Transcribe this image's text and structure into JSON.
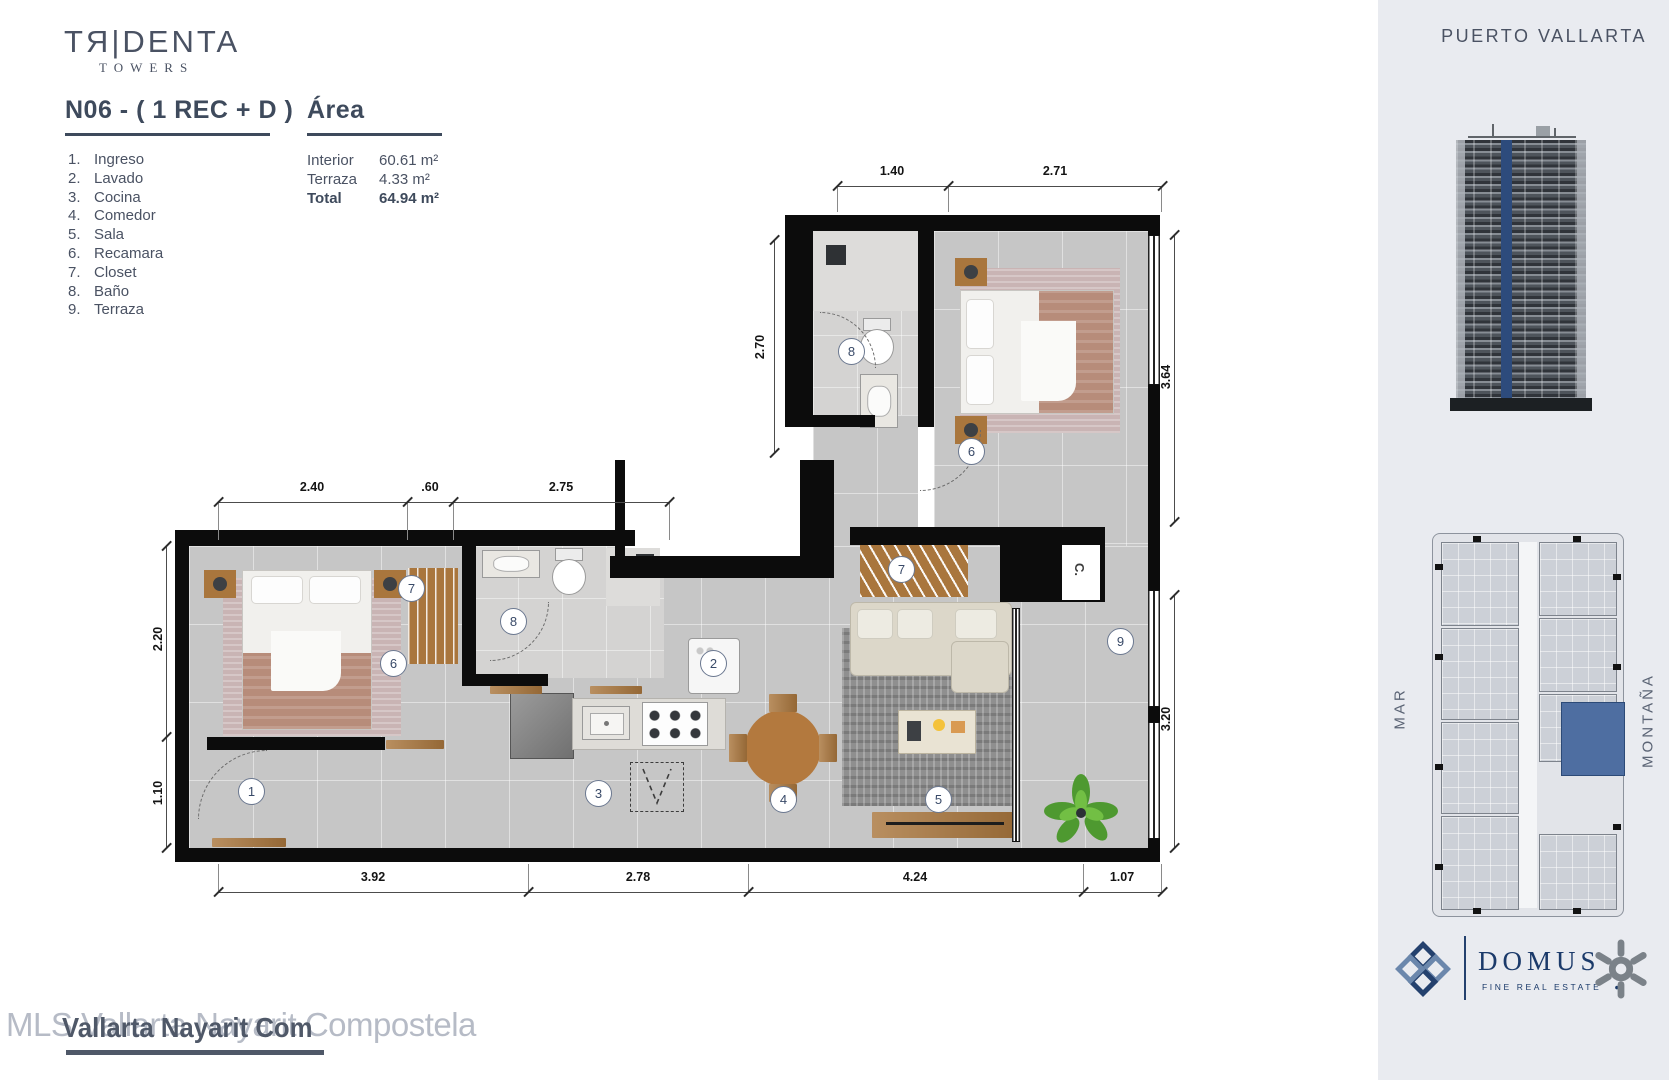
{
  "branding": {
    "logo": "TЯ|DENTA",
    "logo_sub": "TOWERS"
  },
  "header": {
    "unit_title": "N06 - ( 1 REC + D )",
    "area_title": "Área"
  },
  "legend": [
    {
      "num": "1.",
      "label": "Ingreso"
    },
    {
      "num": "2.",
      "label": "Lavado"
    },
    {
      "num": "3.",
      "label": "Cocina"
    },
    {
      "num": "4.",
      "label": "Comedor"
    },
    {
      "num": "5.",
      "label": "Sala"
    },
    {
      "num": "6.",
      "label": "Recamara"
    },
    {
      "num": "7.",
      "label": "Closet"
    },
    {
      "num": "8.",
      "label": "Baño"
    },
    {
      "num": "9.",
      "label": "Terraza"
    }
  ],
  "areas": [
    {
      "label": "Interior",
      "value": "60.61 m²"
    },
    {
      "label": "Terraza",
      "value": "4.33 m²"
    },
    {
      "label": "Total",
      "value": "64.94 m²"
    }
  ],
  "plan": {
    "dims": {
      "top1": "1.40",
      "top2": "2.71",
      "bath_h": "2.70",
      "wing1": "2.40",
      "wing2": ".60",
      "wing3": "2.75",
      "left1": "2.20",
      "left2": "1.10",
      "right1": "3.64",
      "right2": "3.20",
      "bottom1": "3.92",
      "bottom2": "2.78",
      "bottom3": "4.24",
      "bottom4": "1.07"
    },
    "markers": {
      "entry": "1",
      "laundry": "2",
      "kitchen": "3",
      "dining": "4",
      "living": "5",
      "bedroom_upper": "6",
      "bedroom_lower": "6",
      "closet_upper": "7",
      "closet_lower": "7",
      "bath_upper": "8",
      "bath_lower": "8",
      "terrace": "9"
    },
    "closet_tag": "C."
  },
  "sidebar": {
    "city": "PUERTO VALLARTA",
    "orientation_left": "MAR",
    "orientation_right": "MONTAÑA",
    "domus_name": "DOMUS",
    "domus_tagline": "FINE REAL ESTATE",
    "domus_dot": "●"
  },
  "watermark": {
    "base": "MLS Vallarta Nayarit Compostela",
    "overlay": "Vallarta Nayarit Com"
  },
  "colors": {
    "accent_blue": "#2d4b7c",
    "highlight_unit": "#4e6ea1",
    "text_slate": "#4a5263",
    "wall_black": "#0c0c0c"
  }
}
